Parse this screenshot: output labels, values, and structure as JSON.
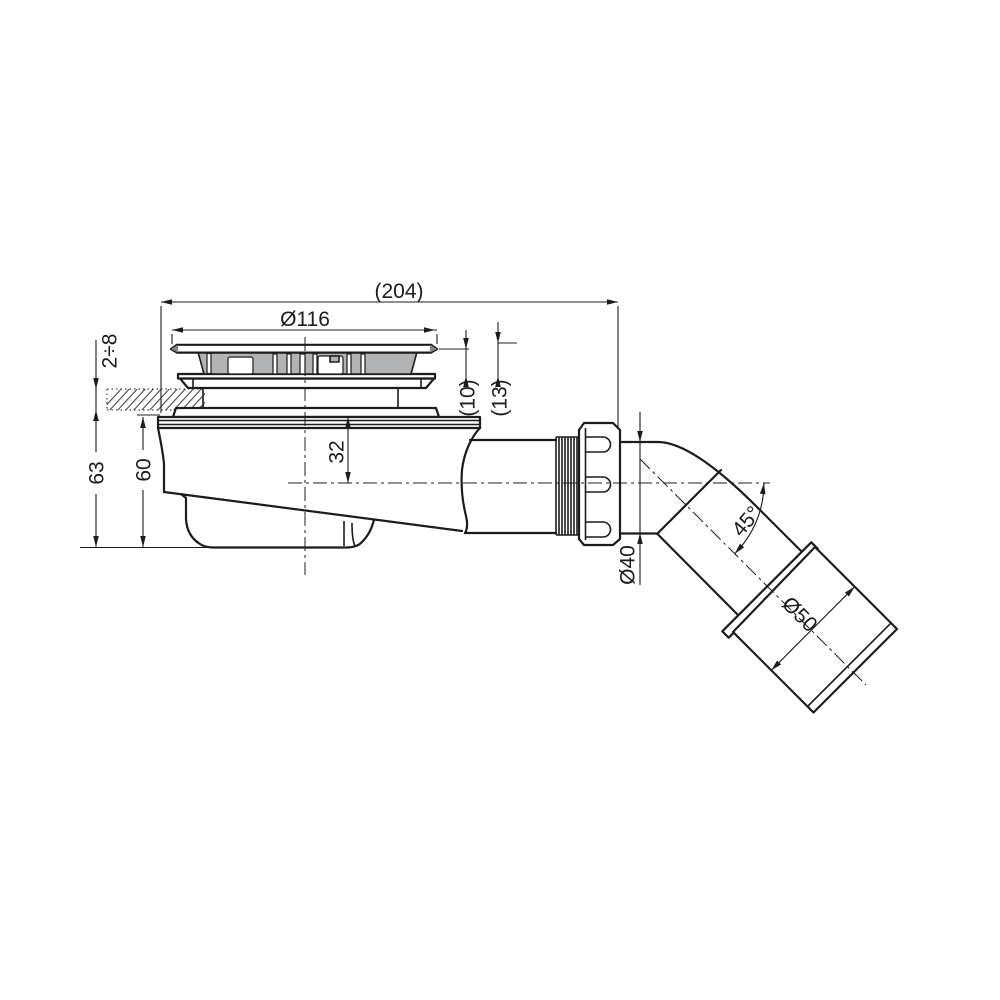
{
  "drawing": {
    "title": "shower drain trap side section technical drawing",
    "labels": {
      "overall_width": "(204)",
      "grate_diameter": "Ø116",
      "tile_range": "2÷8",
      "flange_height": "(10)",
      "flange_height_total": "(13)",
      "axis_depth": "32",
      "height_total": "63",
      "height_body": "60",
      "outlet_diameter": "Ø40",
      "outlet_angle": "45°",
      "socket_diameter": "Ø50"
    },
    "colors": {
      "line": "#1c1c1c",
      "grate_fill": "#b1b3b5",
      "background": "#ffffff"
    }
  }
}
